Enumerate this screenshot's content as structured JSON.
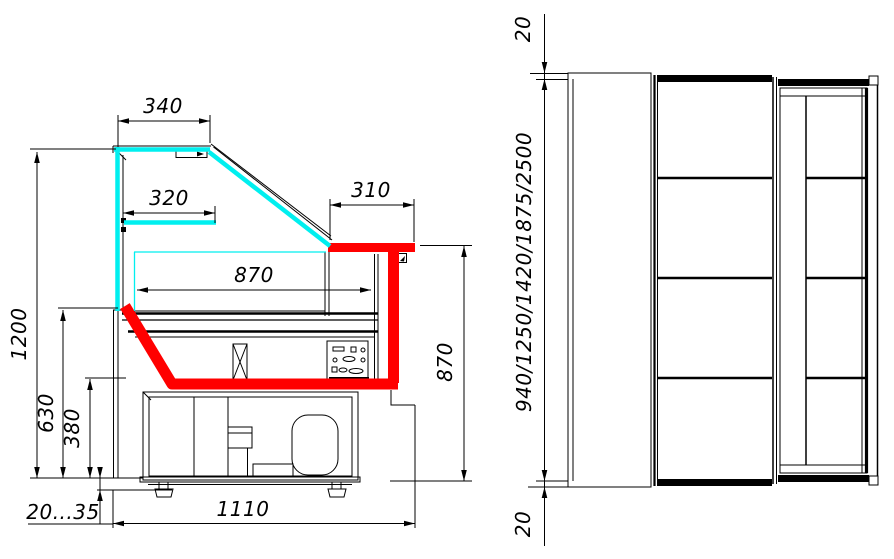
{
  "colors": {
    "line": "#000000",
    "glass": "#00efef",
    "highlight": "#ff0000",
    "background": "#ffffff"
  },
  "side_view": {
    "dims": {
      "canopy_width": "340",
      "shelf_width": "320",
      "rear_top_depth": "310",
      "display_depth": "870",
      "overall_height": "1200",
      "front_glass_height": "630",
      "base_height": "380",
      "leg_adjustment": "20...35",
      "overall_depth": "1110",
      "rear_height": "870"
    }
  },
  "plan_view": {
    "dims": {
      "end_overhang_top": "20",
      "end_overhang_bottom": "20",
      "available_lengths": "940/1250/1420/1875/2500"
    }
  }
}
